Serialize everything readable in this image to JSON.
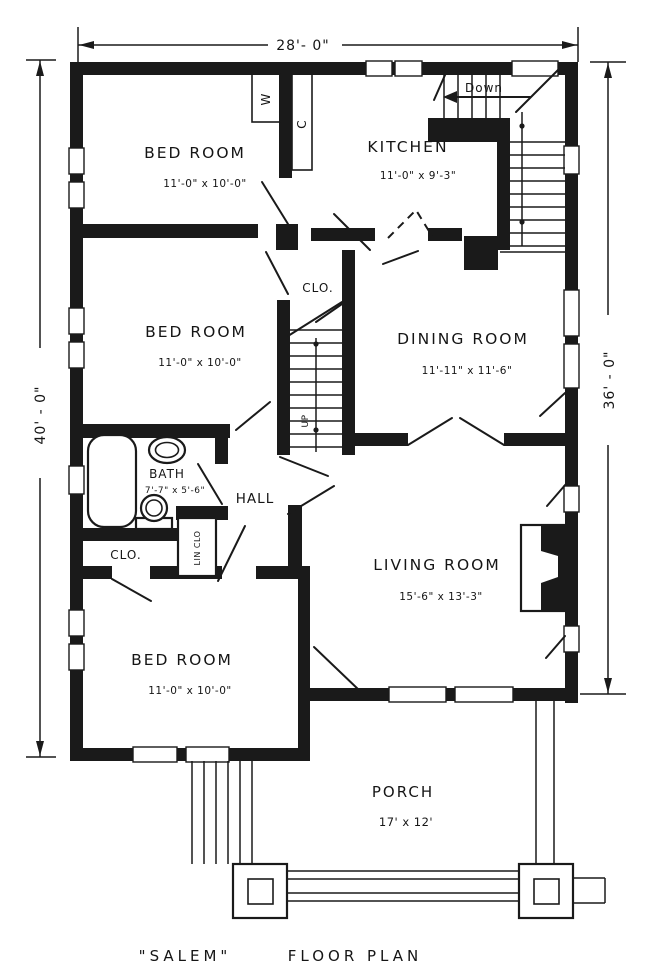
{
  "plan": {
    "caption_name": "\"SALEM\"",
    "caption_label": "FLOOR PLAN",
    "dim_top": "28'- 0\"",
    "dim_left": "40' - 0\"",
    "dim_right": "36' - 0\"",
    "rooms": {
      "bedroom_top": {
        "name": "BED ROOM",
        "size": "11'-0\" x 10'-0\""
      },
      "kitchen": {
        "name": "KITCHEN",
        "size": "11'-0\" x 9'-3\""
      },
      "bedroom_mid": {
        "name": "BED ROOM",
        "size": "11'-0\" x 10'-0\""
      },
      "dining": {
        "name": "DINING ROOM",
        "size": "11'-11\" x 11'-6\""
      },
      "bath": {
        "name": "BATH",
        "size": "7'-7\" x 5'-6\""
      },
      "hall": {
        "name": "HALL"
      },
      "bedroom_bottom": {
        "name": "BED ROOM",
        "size": "11'-0\" x 10'-0\""
      },
      "living": {
        "name": "LIVING ROOM",
        "size": "15'-6\" x 13'-3\""
      },
      "porch": {
        "name": "PORCH",
        "size": "17' x 12'"
      }
    },
    "labels": {
      "closet_center": "CLO.",
      "closet_hall": "CLO.",
      "linen": "LIN CLO",
      "wardrobe": "W",
      "closet_kitchen": "C",
      "stairs_up": "UP",
      "stairs_down": "Down"
    },
    "colors": {
      "ink": "#1a1a1a",
      "paper": "#ffffff"
    }
  }
}
